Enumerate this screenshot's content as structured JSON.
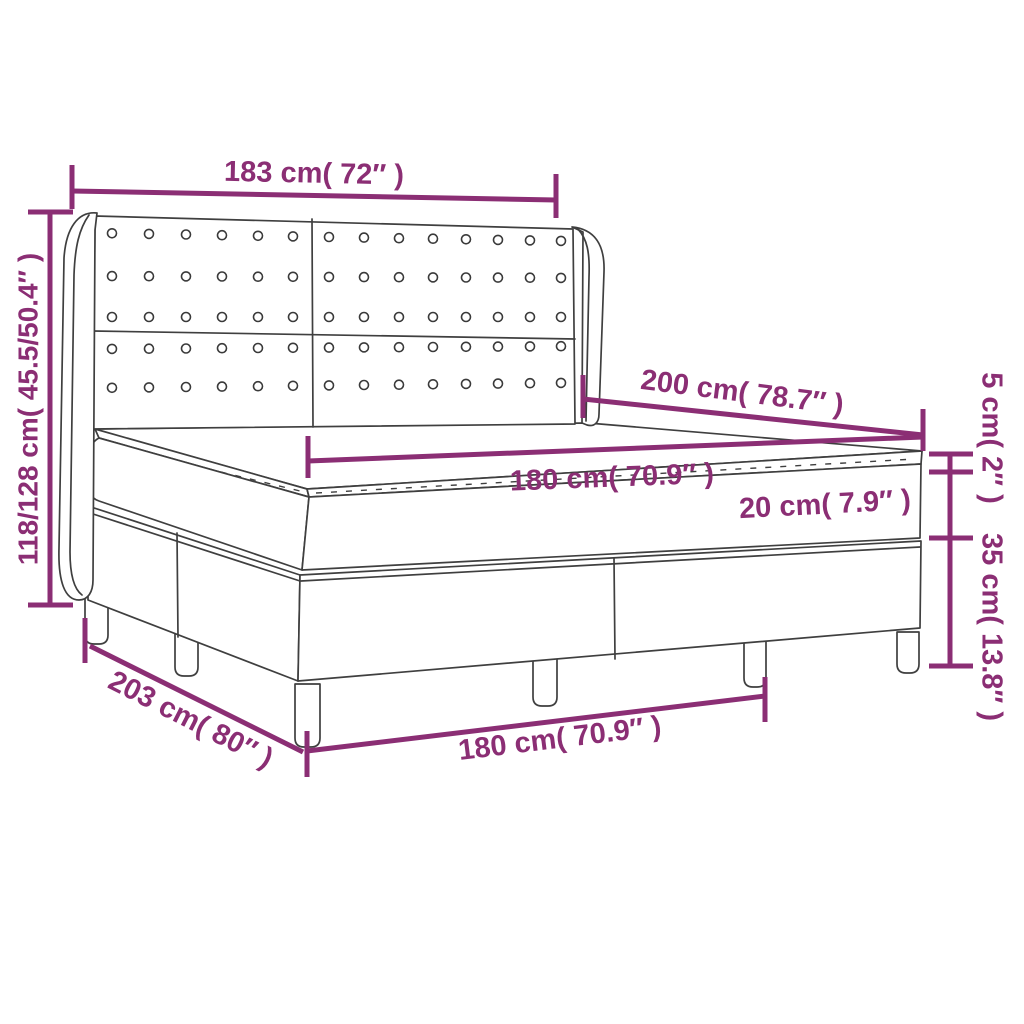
{
  "diagram": {
    "type": "product dimension diagram",
    "product": "box spring bed with tufted wingback headboard, mattress and topper",
    "colors": {
      "accent": "#8B2E74",
      "line_art": "#3F3F3F",
      "background": "#FFFFFF"
    },
    "labels": {
      "headboard_width": "183 cm( 72″ )",
      "overall_height": "118/128 cm( 45.5/50.4″ )",
      "bed_length": "200 cm( 78.7″ )",
      "mattress_width": "180 cm( 70.9″ )",
      "mattress_height": "20 cm( 7.9″ )",
      "topper_height": "5 cm( 2″ )",
      "base_height": "35 cm( 13.8″ )",
      "base_length": "203 cm( 80″ )",
      "base_width": "180 cm( 70.9″ )"
    }
  }
}
